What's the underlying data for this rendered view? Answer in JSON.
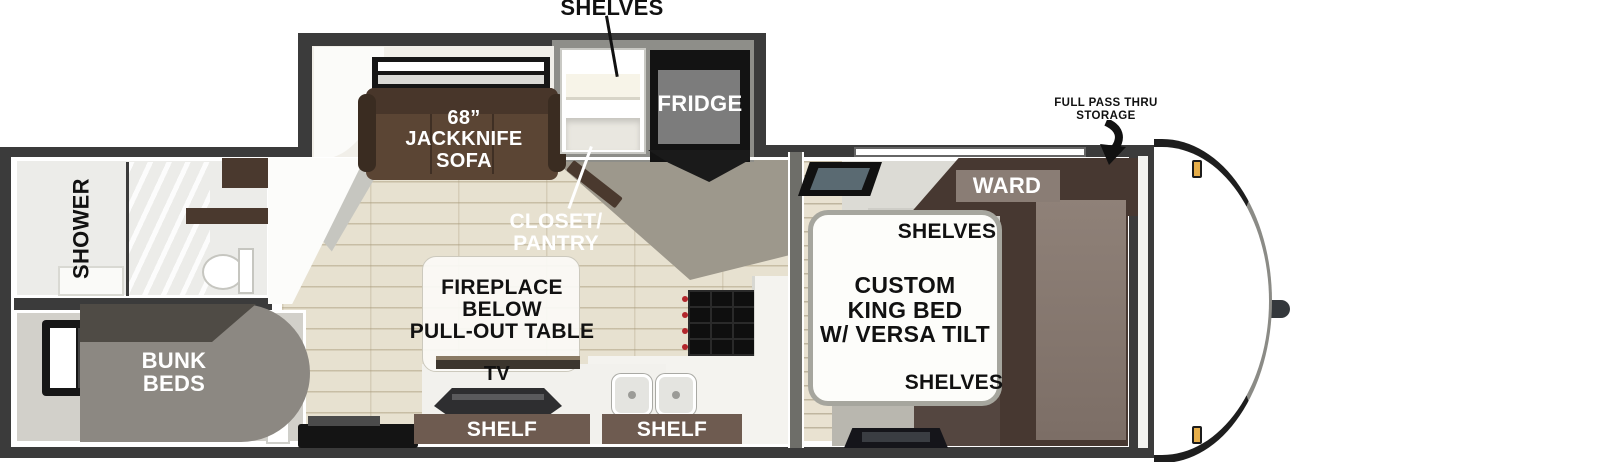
{
  "floorplan": {
    "type": "travel-trailer-floorplan",
    "labels": {
      "shelves_top": "SHELVES",
      "fridge": "FRIDGE",
      "sofa": "68”\nJACKKNIFE\nSOFA",
      "closet_pantry": "CLOSET/\nPANTRY",
      "shower": "SHOWER",
      "bunk_beds": "BUNK\nBEDS",
      "fireplace_table": "FIREPLACE\nBELOW\nPULL-OUT TABLE",
      "tv": "TV",
      "shelf_left": "SHELF",
      "shelf_right": "SHELF",
      "king_bed": "CUSTOM\nKING BED\nW/ VERSA TILT",
      "shelves_bed_top": "SHELVES",
      "shelves_bed_bottom": "SHELVES",
      "ward": "WARD",
      "pass_thru_storage": "FULL PASS THRU\nSTORAGE"
    },
    "colors": {
      "wall_dark": "#3b3b3b",
      "floor_wood": "#e7e1d0",
      "floor_gray": "#9d988c",
      "sofa_brown": "#5b4534",
      "wardrobe_brown": "#473831",
      "shelf_bar_brown": "#6e5b50",
      "fridge_black": "#131313",
      "stove_black": "#0f0f0f",
      "stove_knob_red": "#b3272d",
      "shower_glass": "#c9d6d0",
      "marker_light_amber": "#e6ae4a",
      "bunk_gray": "#8c8882",
      "bed_white": "#fdfdfa"
    }
  }
}
